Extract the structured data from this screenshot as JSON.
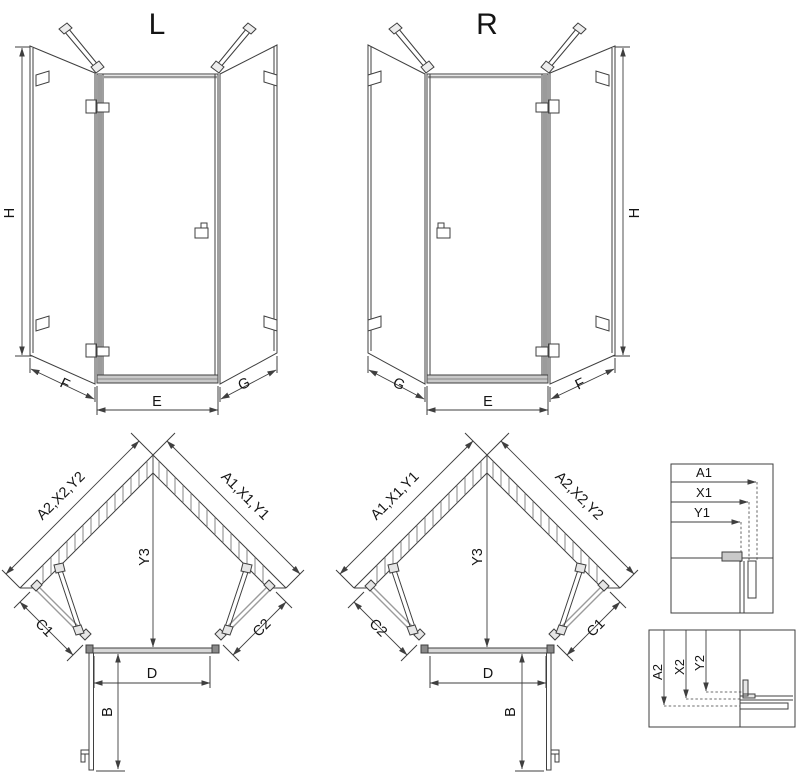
{
  "diagram": {
    "left_variant": {
      "label": "L",
      "elevation": {
        "height": "H",
        "left_side": "F",
        "front": "E",
        "right_side": "G"
      },
      "plan": {
        "wall_left": "A2,X2,Y2",
        "wall_right": "A1,X1,Y1",
        "depth": "Y3",
        "panel_left": "C1",
        "panel_right": "C2",
        "door_width": "D",
        "door_swing": "B"
      }
    },
    "right_variant": {
      "label": "R",
      "elevation": {
        "height": "H",
        "left_side": "G",
        "front": "E",
        "right_side": "F"
      },
      "plan": {
        "wall_left": "A1,X1,Y1",
        "wall_right": "A2,X2,Y2",
        "depth": "Y3",
        "panel_left": "C2",
        "panel_right": "C1",
        "door_width": "D",
        "door_swing": "B"
      }
    },
    "detail_horizontal": {
      "dim1": "A1",
      "dim2": "X1",
      "dim3": "Y1"
    },
    "detail_vertical": {
      "dim1": "A2",
      "dim2": "X2",
      "dim3": "Y2"
    },
    "colors": {
      "line": "#3f3f3f",
      "glass_profile": "#9b9b9b",
      "sill_fill": "#c9c9c9",
      "background": "#ffffff"
    }
  }
}
